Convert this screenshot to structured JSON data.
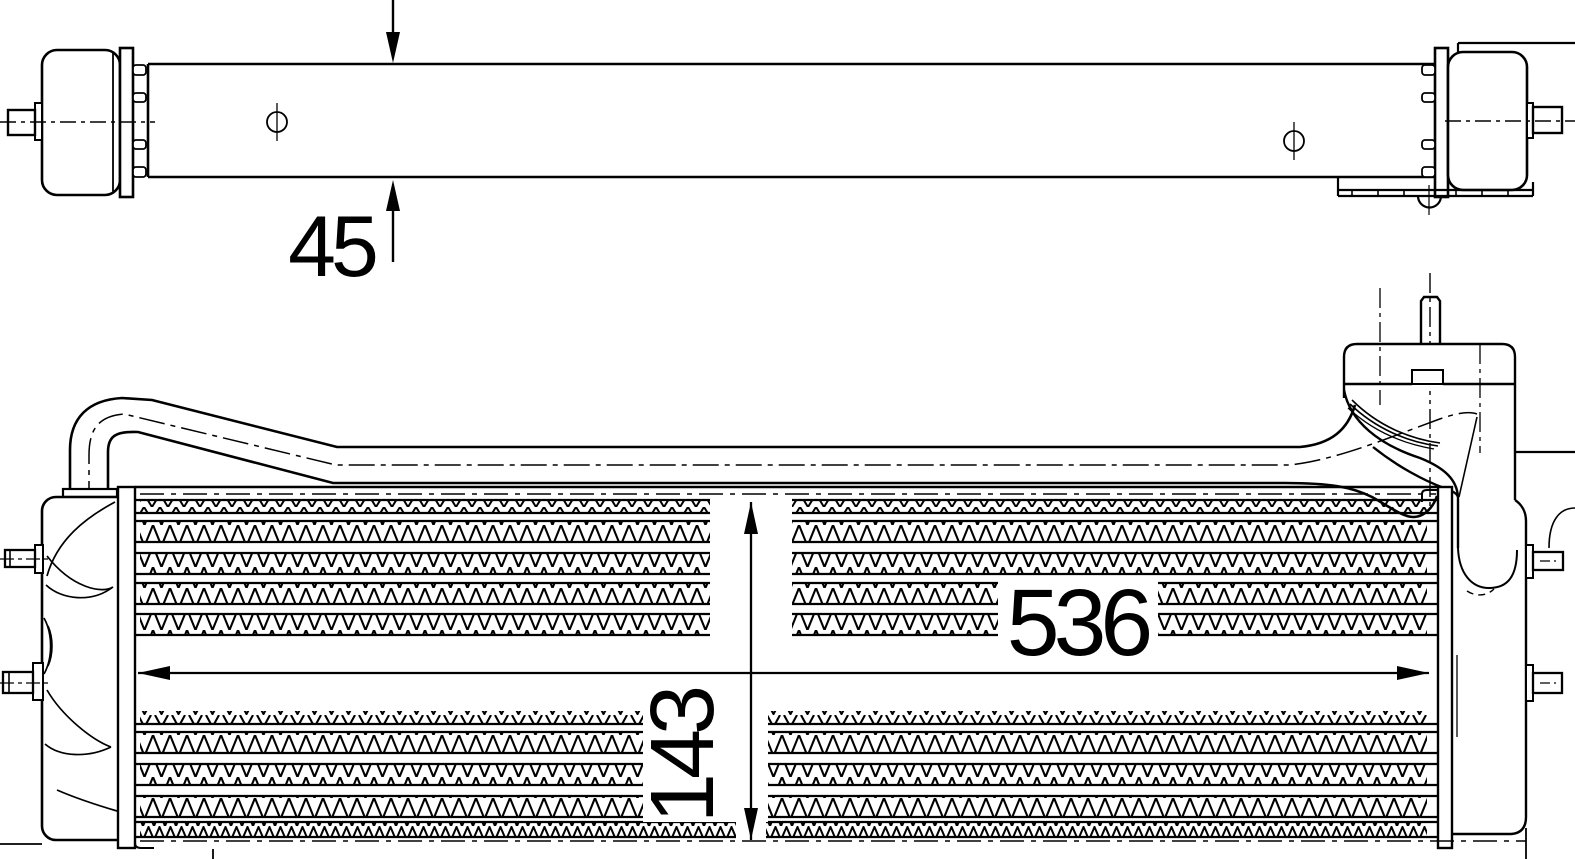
{
  "drawing": {
    "background": "#ffffff",
    "line_color": "#000000",
    "views": {
      "side_view": {
        "dimensions": {
          "height": "45"
        }
      },
      "front_view": {
        "dimensions": {
          "width": "536",
          "height": "143"
        }
      }
    }
  }
}
